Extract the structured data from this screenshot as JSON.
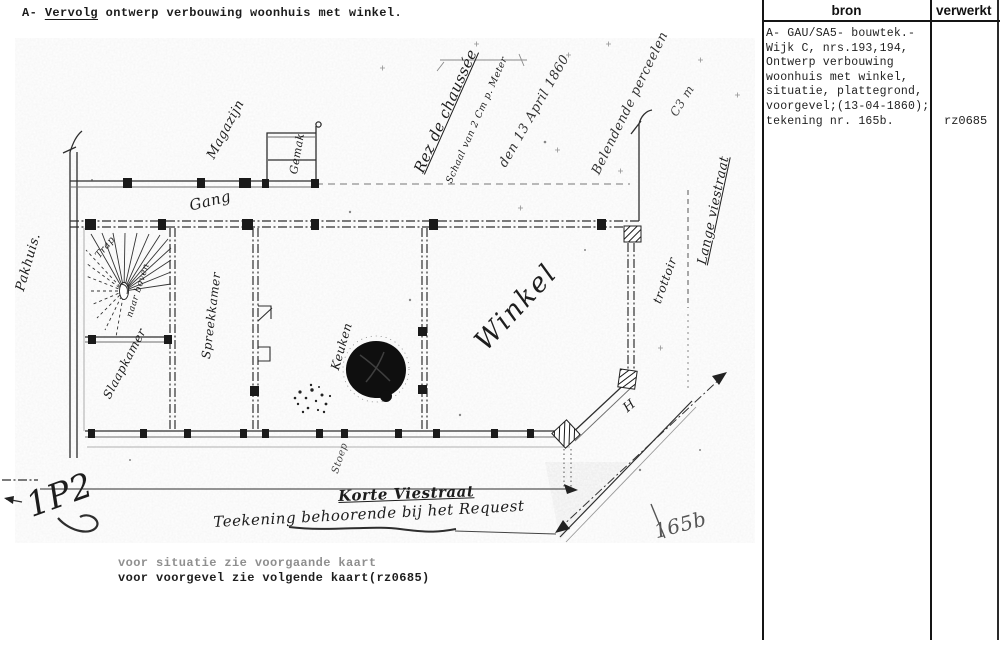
{
  "page": {
    "title": "archief microfiche - ontwerp verbouwing woonhuis met winkel",
    "colors": {
      "paper": "#ffffff",
      "ink": "#1d1d1d",
      "drawing_ink": "#2e2e2e",
      "faded": "#8f8f8f"
    }
  },
  "header": {
    "prefix": "A- ",
    "underlined": "Vervolg",
    "rest": " ontwerp verbouwing woonhuis met winkel."
  },
  "captions": {
    "line1": "voor situatie zie voorgaande kaart",
    "line2": "voor voorgevel zie volgende kaart(rz0685)"
  },
  "table": {
    "headers": {
      "bron": "bron",
      "verwerkt": "verwerkt"
    },
    "source_lines": [
      "A- GAU/SA5- bouwtek.-",
      "Wijk C, nrs.193,194,",
      "Ontwerp verbouwing",
      "woonhuis met winkel,",
      "situatie, plattegrond,",
      "voorgevel;(13-04-1860);",
      "tekening nr. 165b."
    ],
    "verwerkt_value": "rz0685"
  },
  "plan": {
    "annotations": [
      {
        "name": "label-pakhuis",
        "text": "Pakhuis.",
        "x": 14,
        "y": 302,
        "rot": -74,
        "size": 13
      },
      {
        "name": "label-magazijn",
        "text": "Magazijn",
        "x": 205,
        "y": 168,
        "rot": -62,
        "size": 13
      },
      {
        "name": "label-gang",
        "text": "Gang",
        "x": 188,
        "y": 214,
        "rot": -14,
        "size": 15
      },
      {
        "name": "label-gemak",
        "text": "Gemak",
        "x": 288,
        "y": 184,
        "rot": -80,
        "size": 11
      },
      {
        "name": "label-rez-de-chaussee",
        "text": "Rez de chaussée",
        "x": 412,
        "y": 184,
        "rot": -66,
        "size": 15,
        "underline": true
      },
      {
        "name": "label-schaal",
        "text": "Schaal van 2 Cm p. Meter",
        "x": 445,
        "y": 190,
        "rot": -66,
        "size": 9.5
      },
      {
        "name": "annotation-date",
        "text": "den 13 April 1860",
        "x": 497,
        "y": 176,
        "rot": -60,
        "size": 13,
        "color": "#333"
      },
      {
        "name": "annotation-belendend",
        "text": "Belendende perceelen",
        "x": 590,
        "y": 184,
        "rot": -64,
        "size": 13,
        "color": "#333"
      },
      {
        "name": "annotation-mark",
        "text": "C3 m",
        "x": 668,
        "y": 124,
        "rot": -58,
        "size": 12,
        "color": "#444"
      },
      {
        "name": "label-lange-viestraat",
        "text": "Lange viestraat",
        "x": 696,
        "y": 276,
        "rot": -78,
        "size": 13,
        "underline": true
      },
      {
        "name": "label-trottoir",
        "text": "trottoir",
        "x": 651,
        "y": 313,
        "rot": -70,
        "size": 12
      },
      {
        "name": "label-trap",
        "text": "Trap",
        "x": 94,
        "y": 263,
        "rot": -50,
        "size": 9.5
      },
      {
        "name": "label-naar-boven",
        "text": "naar boven",
        "x": 126,
        "y": 325,
        "rot": -72,
        "size": 9
      },
      {
        "name": "label-spreekkamer",
        "text": "Spreekkamer",
        "x": 200,
        "y": 370,
        "rot": -83,
        "size": 12
      },
      {
        "name": "label-slaapkamer",
        "text": "Slaapkamer",
        "x": 101,
        "y": 407,
        "rot": -62,
        "size": 12
      },
      {
        "name": "label-keuken",
        "text": "Keuken",
        "x": 329,
        "y": 380,
        "rot": -74,
        "size": 12
      },
      {
        "name": "label-winkel",
        "text": "Winkel",
        "x": 470,
        "y": 364,
        "rot": -47,
        "size": 27,
        "spacing": "2px"
      },
      {
        "name": "label-h-mark",
        "text": "H",
        "x": 621,
        "y": 418,
        "rot": -40,
        "size": 13
      },
      {
        "name": "label-stoep",
        "text": "Stoep",
        "x": 331,
        "y": 482,
        "rot": -72,
        "size": 10,
        "color": "#444"
      },
      {
        "name": "label-korte-viestraat",
        "text": "Korte Viestraat",
        "x": 338,
        "y": 504,
        "rot": -2,
        "size": 15,
        "underline": true,
        "weight": "700"
      },
      {
        "name": "label-teekening-request",
        "text": "Teekening behoorende bij het Request",
        "x": 213,
        "y": 530,
        "rot": -3,
        "size": 15
      },
      {
        "name": "mark-1p2",
        "text": "1P2",
        "x": 22,
        "y": 525,
        "rot": -20,
        "size": 34
      },
      {
        "name": "mark-165b",
        "text": "165b",
        "x": 652,
        "y": 542,
        "rot": -15,
        "size": 20,
        "color": "#555"
      }
    ]
  }
}
